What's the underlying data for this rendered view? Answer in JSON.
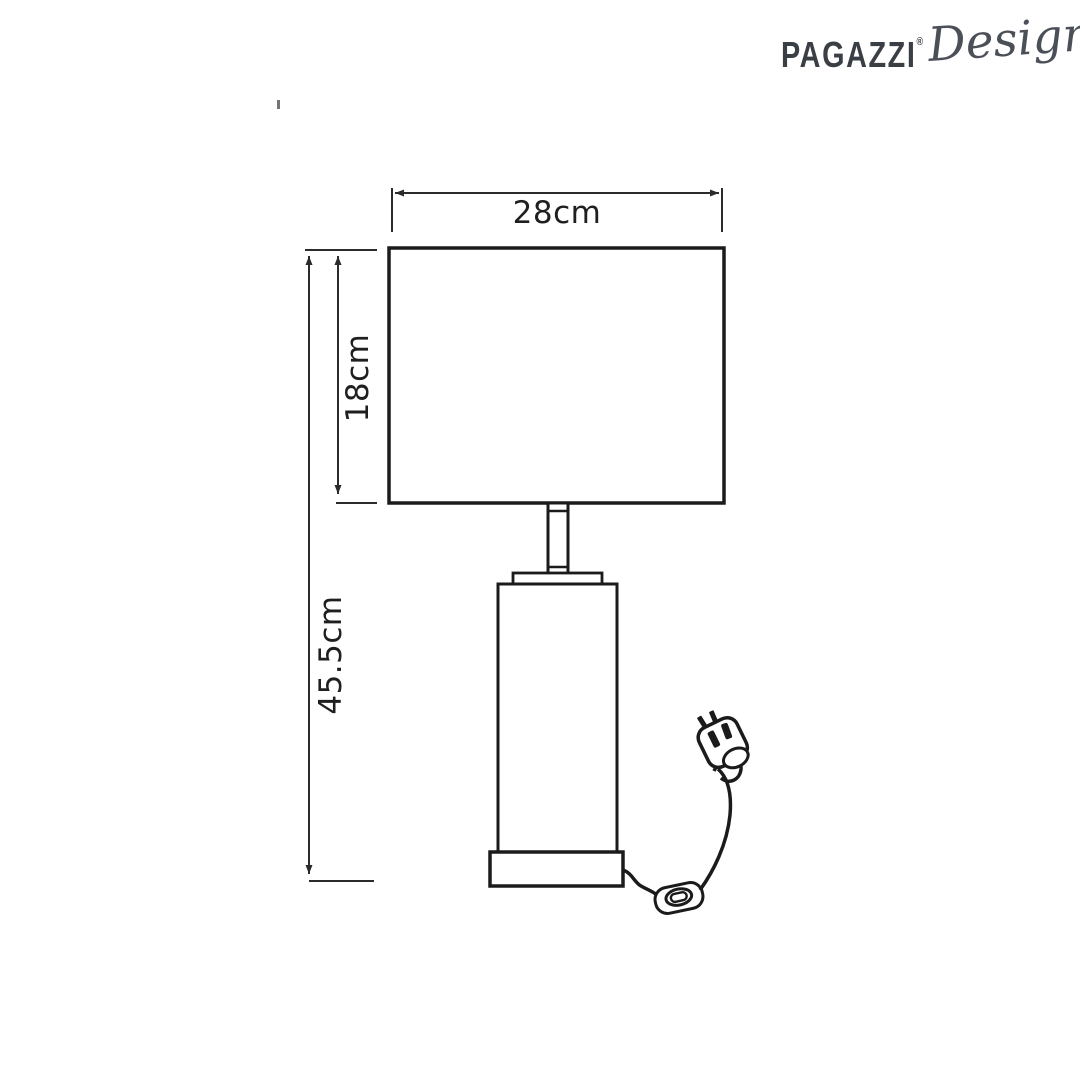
{
  "logo": {
    "brand": "PAGAZZI",
    "registered": "®",
    "suffix": "Design"
  },
  "dimensions": {
    "shade_width": "28cm",
    "shade_height": "18cm",
    "total_height": "45.5cm"
  },
  "diagram": {
    "parts": [
      "lamp-shade",
      "neck",
      "cap-plate",
      "cylindrical-body",
      "base",
      "power-cable",
      "inline-switch",
      "uk-3-pin-plug"
    ]
  },
  "colors": {
    "background": "#ffffff",
    "drawing_line": "#1b1b1b",
    "dimension_line": "#2b2b2b",
    "label_text": "#1f1f1f",
    "logo_text": "#3a3e45",
    "logo_script": "#4b4f57"
  }
}
